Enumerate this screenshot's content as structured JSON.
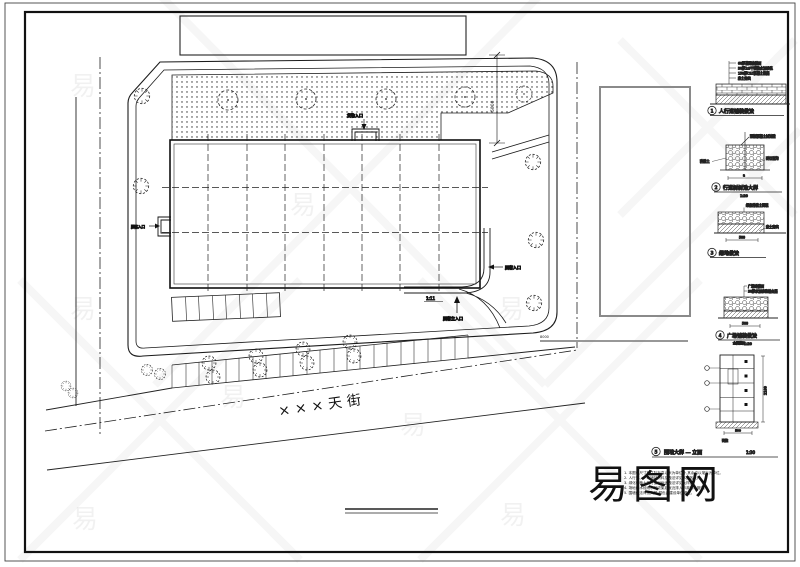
{
  "street": {
    "name": "×××天街"
  },
  "site": {
    "dim_top": "5000",
    "dim_right": "8000",
    "ramp": "1:11",
    "entrance_top": "货物入口",
    "entrance_left": "顾客入口",
    "entrance_right": "顾客入口",
    "entrance_main": "顾客主入口"
  },
  "details": [
    {
      "num": "1",
      "title": "人行道铺装做法",
      "scale": "1:20",
      "notes": [
        "60厚花岗岩铺面",
        "30厚1:3干硬性水泥砂浆",
        "150厚C15混凝土垫层",
        "素土夯实"
      ],
      "dim": "500"
    },
    {
      "num": "2",
      "title": "行道树树池大样",
      "scale": "1:20",
      "notes": [
        "预制混凝土树池壁",
        "种植土",
        "碎石盲沟"
      ],
      "dim": "a"
    },
    {
      "num": "3",
      "title": "绿地做法",
      "scale": "1:20",
      "notes": [
        "绿化种植土回填",
        "素土夯实"
      ],
      "dim": "500"
    },
    {
      "num": "4",
      "title": "广场铺装做法",
      "scale": "1:20",
      "notes": [
        "广场砖铺面",
        "30厚水泥砂浆结合层"
      ],
      "dim": "500"
    },
    {
      "num": "5",
      "title": "围墙大样 — 立面",
      "scale": "1:30",
      "notes": [
        "金属栏杆",
        "砖柱"
      ],
      "dim": "2100",
      "dim2": "500"
    }
  ],
  "notes": {
    "lines": [
      "1. 本图中尺寸标注除标高以米为单位外,其余均以毫米为单位。",
      "2. 人行道、广场铺装材料及做法详见本图各大样。",
      "3. 绿化种植土及行道树树池做法详见大样图。",
      "4. 场地雨水经雨水口收集后就近排入市政雨水管网。",
      "5. 围墙做法详见大样,颜色由建设单位确定。"
    ]
  },
  "watermark": {
    "glyph": "易",
    "brand": "易图网"
  }
}
